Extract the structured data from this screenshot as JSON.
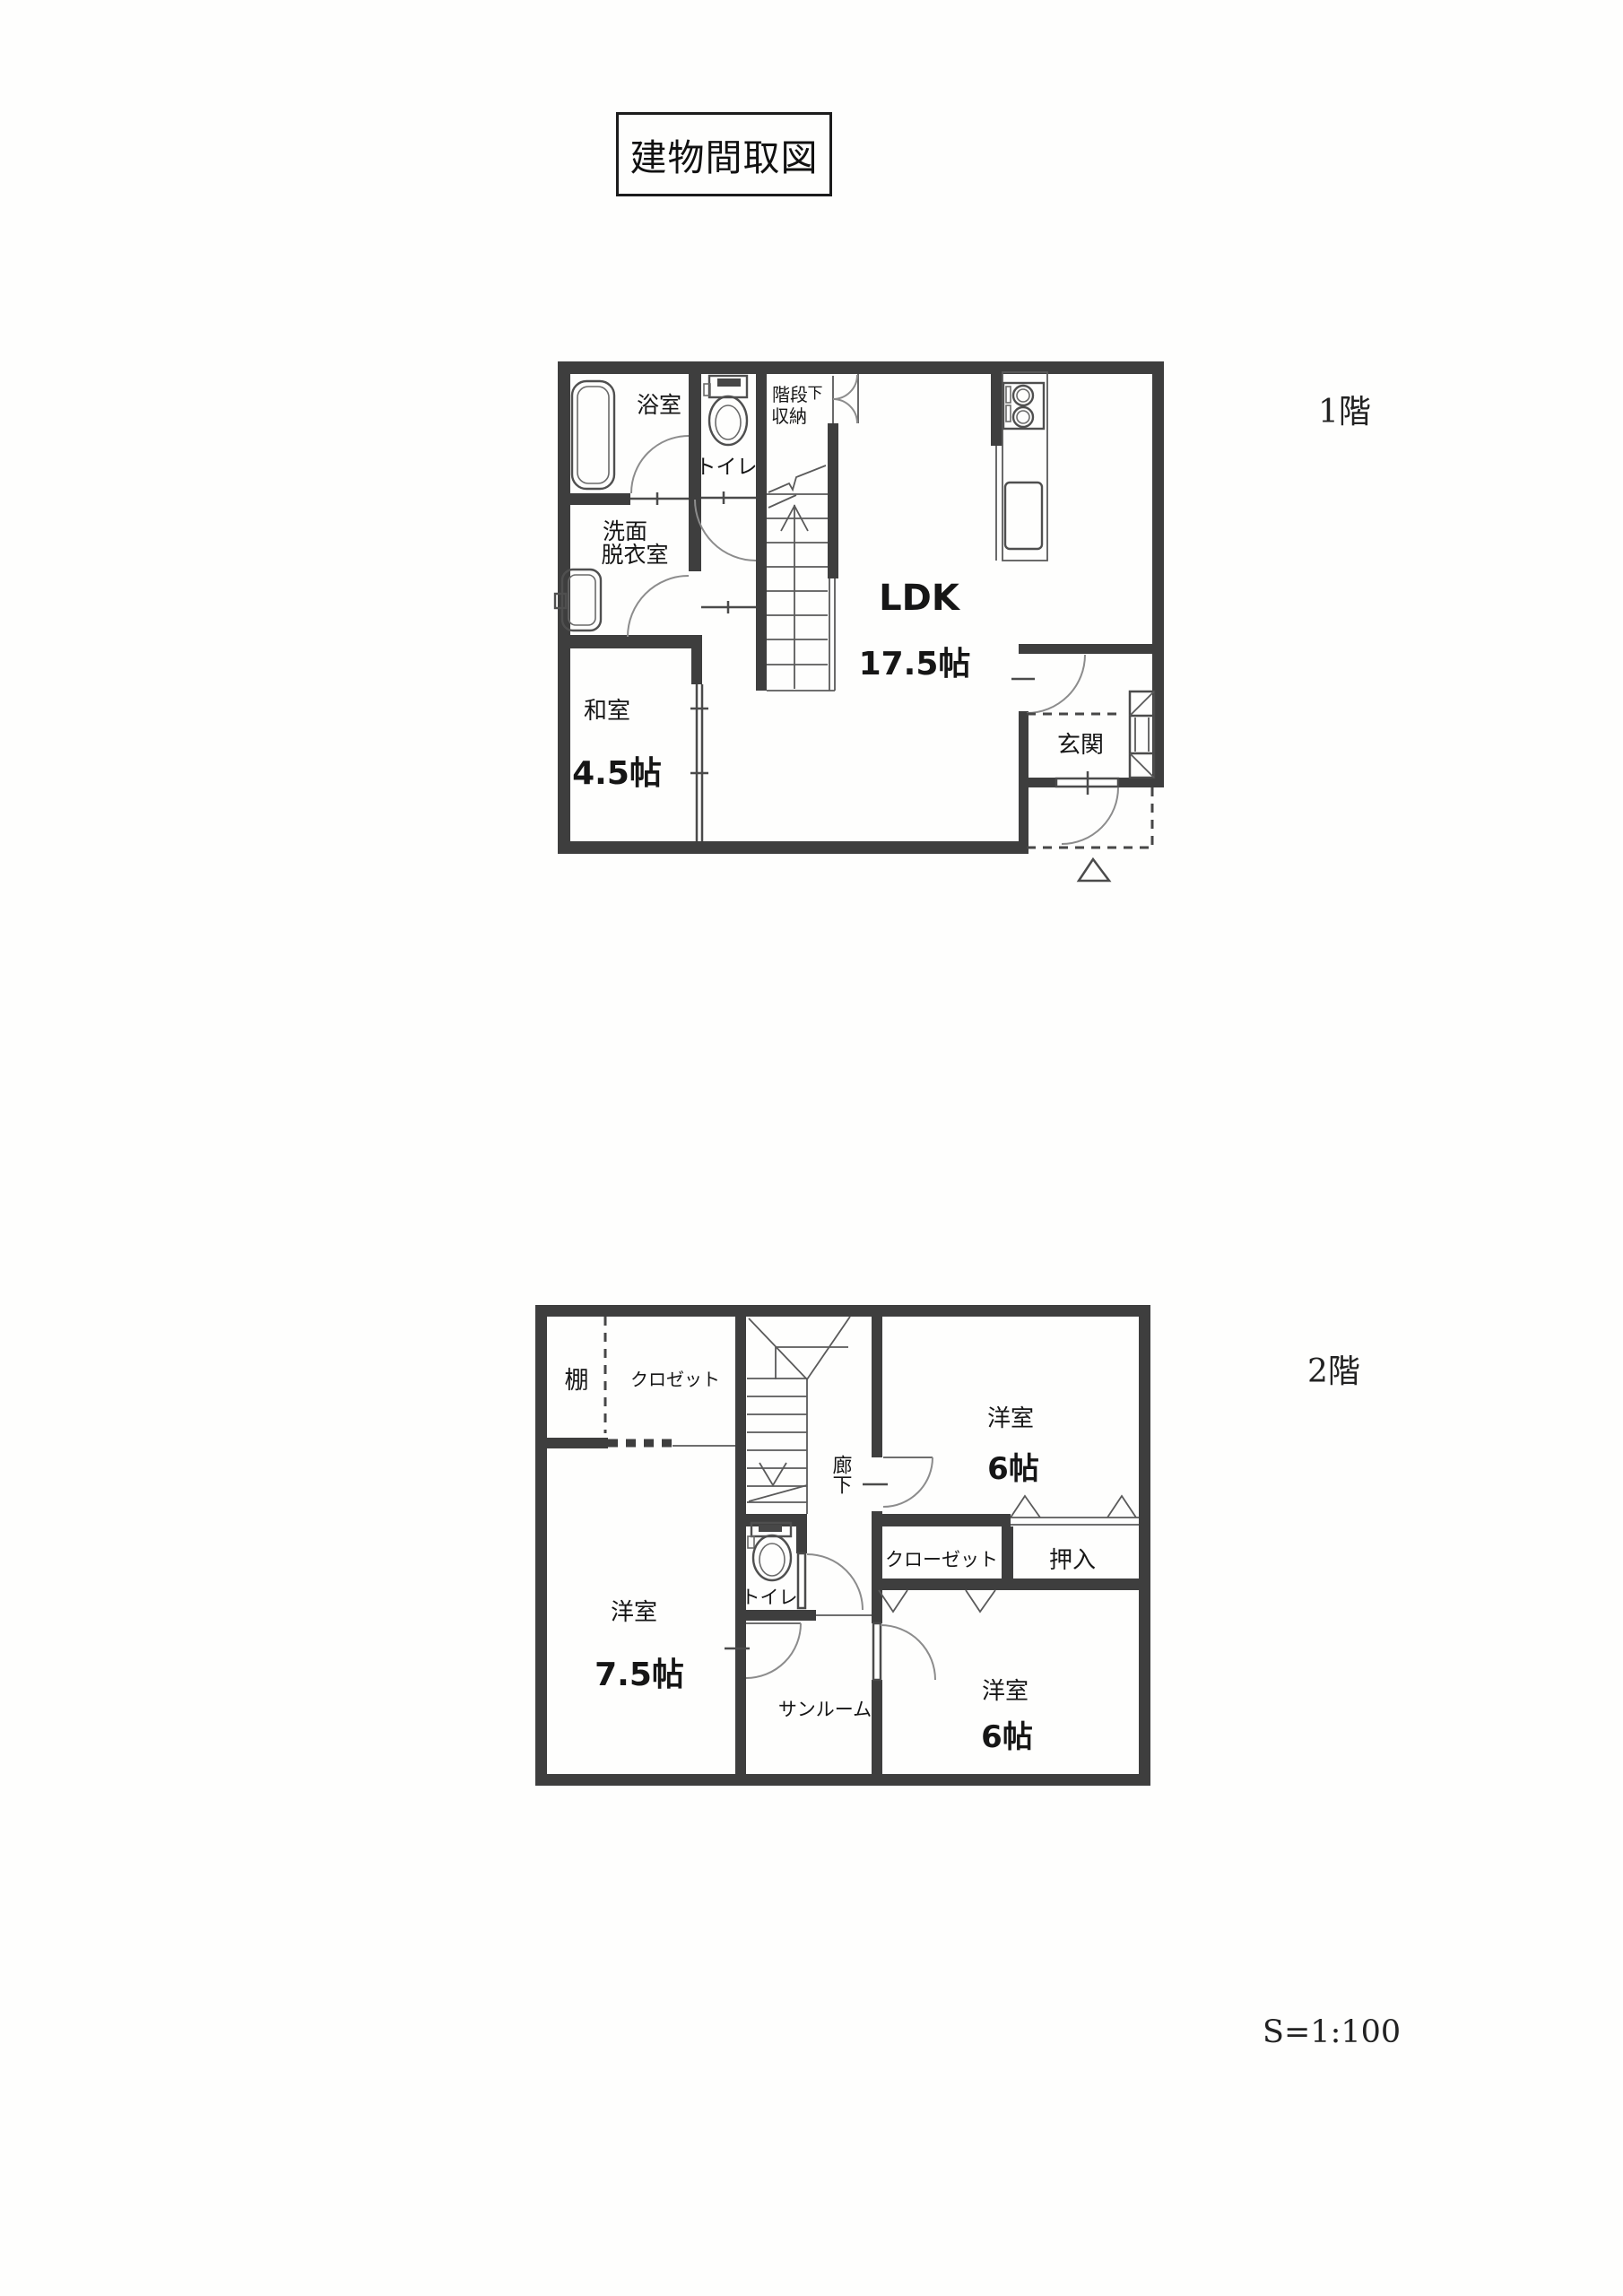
{
  "page": {
    "title": "建物間取図",
    "scale_note": "S=1:100"
  },
  "floor1": {
    "label": "1階",
    "rooms": {
      "bath": "浴室",
      "toilet": "トイレ",
      "stairs_storage_1": "階段",
      "stairs_storage_2": "下",
      "stairs_storage_3": "収納",
      "washroom_1": "洗面",
      "washroom_2": "脱衣室",
      "ldk": "LDK",
      "ldk_size": "17.5帖",
      "washitsu": "和室",
      "washitsu_size": "4.5帖",
      "entrance": "玄関"
    }
  },
  "floor2": {
    "label": "2階",
    "rooms": {
      "shelf": "棚",
      "closet": "クロゼット",
      "corridor": "廊下",
      "bedroom_ne": "洋室",
      "bedroom_ne_size": "6帖",
      "closet_long": "クローゼット",
      "oshiire": "押入",
      "toilet": "トイレ",
      "bedroom_w": "洋室",
      "bedroom_w_size": "7.5帖",
      "sunroom": "サンルーム",
      "bedroom_se": "洋室",
      "bedroom_se_size": "6帖"
    }
  },
  "colors": {
    "wall": "#3e3e3e",
    "thin_line": "#4b4b4b",
    "door_arc": "#8c8c8c",
    "text": "#161616",
    "paper": "#fefefd"
  }
}
